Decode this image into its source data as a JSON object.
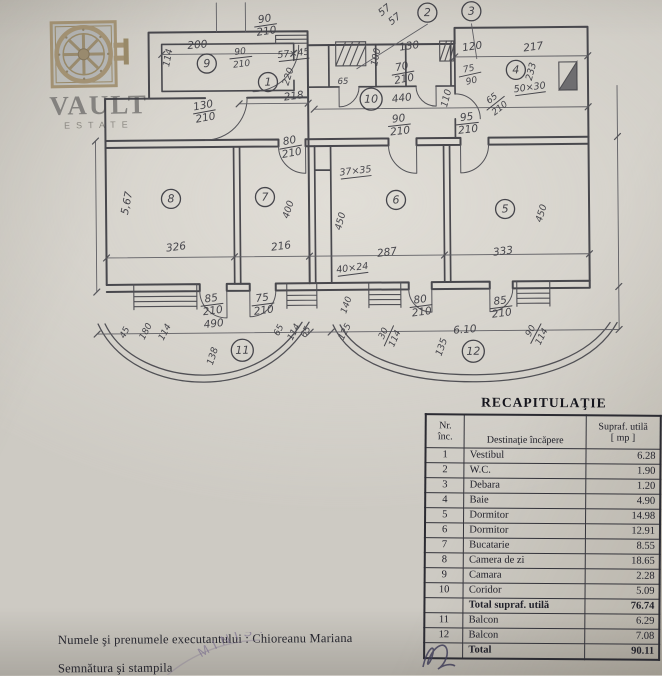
{
  "watermark": {
    "brand": "VAULT",
    "sub": "ESTATE"
  },
  "colors": {
    "paper": "#cdcac3",
    "ink": "#3e3e44",
    "dim_ink": "#56565c",
    "table_ink": "#22222b",
    "stamp": "#766998",
    "logo_bronze": "#97835f"
  },
  "floor_plan": {
    "labels": [
      {
        "t": "200",
        "x": 199,
        "y": 47,
        "r": -4
      },
      {
        "t": "114",
        "x": 172,
        "y": 57,
        "r": -78,
        "s": 9.5
      },
      {
        "t": "9",
        "x": 208,
        "y": 66,
        "c": 1
      },
      {
        "top": "90",
        "bot": "210",
        "x": 242,
        "y": 56,
        "r": -6,
        "s": 9
      },
      {
        "top": "90",
        "bot": "210",
        "x": 267,
        "y": 24,
        "r": -8
      },
      {
        "t": "57×45",
        "x": 295,
        "y": 56,
        "r": -6,
        "u": 1,
        "s": 9.5
      },
      {
        "t": "1",
        "x": 269,
        "y": 85,
        "c": 1
      },
      {
        "t": "220",
        "x": 292,
        "y": 77,
        "r": -72,
        "s": 9.5
      },
      {
        "t": "218",
        "x": 295,
        "y": 99,
        "r": -7
      },
      {
        "top": "130",
        "bot": "210",
        "x": 205,
        "y": 110,
        "r": -10
      },
      {
        "t": "57",
        "x": 388,
        "y": 13,
        "r": -38,
        "s": 10
      },
      {
        "t": "57",
        "x": 398,
        "y": 22,
        "r": -38,
        "s": 10
      },
      {
        "t": "2",
        "x": 429,
        "y": 17,
        "c": 1
      },
      {
        "t": "3",
        "x": 473,
        "y": 16,
        "c": 1
      },
      {
        "t": "130",
        "x": 411,
        "y": 50,
        "r": -8
      },
      {
        "t": "100",
        "x": 380,
        "y": 58,
        "r": -78,
        "s": 9.5
      },
      {
        "top": "70",
        "bot": "210",
        "x": 404,
        "y": 73,
        "r": -10
      },
      {
        "t": "65",
        "x": 344,
        "y": 84,
        "r": 0,
        "s": 8.5
      },
      {
        "t": "10",
        "x": 372,
        "y": 103,
        "c": 1
      },
      {
        "t": "440",
        "x": 403,
        "y": 102,
        "r": -7
      },
      {
        "t": "120",
        "x": 474,
        "y": 51,
        "r": -8
      },
      {
        "top": "75",
        "bot": "90",
        "x": 471,
        "y": 75,
        "r": -12,
        "s": 9
      },
      {
        "t": "110",
        "x": 450,
        "y": 100,
        "r": -75,
        "s": 9.5
      },
      {
        "top": "90",
        "bot": "210",
        "x": 400,
        "y": 125,
        "r": -6
      },
      {
        "top": "95",
        "bot": "210",
        "x": 468,
        "y": 124,
        "r": -6
      },
      {
        "t": "217",
        "x": 535,
        "y": 52,
        "r": -7
      },
      {
        "t": "4",
        "x": 517,
        "y": 75,
        "c": 1
      },
      {
        "t": "233",
        "x": 535,
        "y": 74,
        "r": -75,
        "s": 9.5
      },
      {
        "t": "50×30",
        "x": 531,
        "y": 92,
        "r": -7,
        "u": 1,
        "s": 9.5
      },
      {
        "top": "65",
        "bot": "210",
        "x": 496,
        "y": 104,
        "r": -38,
        "s": 9
      },
      {
        "t": "5,67",
        "x": 130,
        "y": 202,
        "r": -78
      },
      {
        "t": "8",
        "x": 171,
        "y": 201,
        "c": 1
      },
      {
        "t": "326",
        "x": 176,
        "y": 249,
        "r": -7
      },
      {
        "t": "7",
        "x": 265,
        "y": 200,
        "c": 1
      },
      {
        "t": "400",
        "x": 291,
        "y": 210,
        "r": -72,
        "s": 9.5
      },
      {
        "t": "216",
        "x": 281,
        "y": 249,
        "r": -7
      },
      {
        "top": "80",
        "bot": "210",
        "x": 291,
        "y": 146,
        "r": -10
      },
      {
        "t": "37×35",
        "x": 356,
        "y": 174,
        "r": -6,
        "u": 1,
        "s": 9.5
      },
      {
        "t": "6",
        "x": 396,
        "y": 204,
        "c": 1
      },
      {
        "t": "450",
        "x": 343,
        "y": 222,
        "r": -75,
        "s": 9.5
      },
      {
        "t": "287",
        "x": 387,
        "y": 256,
        "r": -7
      },
      {
        "t": "5",
        "x": 505,
        "y": 214,
        "c": 1
      },
      {
        "t": "450",
        "x": 544,
        "y": 216,
        "r": -72,
        "s": 9.5
      },
      {
        "t": "333",
        "x": 503,
        "y": 256,
        "r": -7
      },
      {
        "t": "40×24",
        "x": 352,
        "y": 271,
        "r": -7,
        "u": 1,
        "s": 9.5
      },
      {
        "top": "85",
        "bot": "210",
        "x": 211,
        "y": 303,
        "r": -7
      },
      {
        "top": "75",
        "bot": "210",
        "x": 262,
        "y": 303,
        "r": -7
      },
      {
        "t": "45",
        "x": 126,
        "y": 332,
        "r": -62,
        "s": 9
      },
      {
        "t": "180",
        "x": 147,
        "y": 331,
        "r": -62,
        "s": 9
      },
      {
        "t": "114",
        "x": 166,
        "y": 332,
        "r": -62,
        "s": 9
      },
      {
        "t": "490",
        "x": 213,
        "y": 326,
        "r": -6
      },
      {
        "t": "138",
        "x": 214,
        "y": 356,
        "r": -72,
        "s": 9.5
      },
      {
        "t": "11",
        "x": 241,
        "y": 353,
        "c": 1
      },
      {
        "t": "65",
        "x": 280,
        "y": 331,
        "r": -62,
        "s": 9
      },
      {
        "t": "114",
        "x": 295,
        "y": 333,
        "r": -62,
        "s": 9
      },
      {
        "t": "65",
        "x": 307,
        "y": 333,
        "r": -62,
        "s": 9
      },
      {
        "t": "140",
        "x": 348,
        "y": 306,
        "r": -70,
        "s": 9
      },
      {
        "t": "125",
        "x": 346,
        "y": 333,
        "r": -62,
        "s": 9
      },
      {
        "top": "30",
        "bot": "114",
        "x": 387,
        "y": 336,
        "r": -65,
        "s": 9
      },
      {
        "top": "80",
        "bot": "210",
        "x": 420,
        "y": 306,
        "r": -7
      },
      {
        "t": "6.10",
        "x": 464,
        "y": 334,
        "r": -4
      },
      {
        "t": "135",
        "x": 443,
        "y": 349,
        "r": -70,
        "s": 9.5
      },
      {
        "t": "12",
        "x": 472,
        "y": 356,
        "c": 1
      },
      {
        "top": "85",
        "bot": "210",
        "x": 500,
        "y": 308,
        "r": -7
      },
      {
        "top": "90",
        "bot": "114",
        "x": 534,
        "y": 335,
        "r": -62,
        "s": 9
      }
    ]
  },
  "table": {
    "title": "RECAPITULAŢIE",
    "col_headers": {
      "nr1": "Nr.",
      "nr2": "înc.",
      "dest": "Destinaţie încăpere",
      "sup1": "Supraf. utilă",
      "sup2": "[ mp ]"
    },
    "rows": [
      {
        "nr": "1",
        "dest": "Vestibul",
        "val": "6.28",
        "bold": false
      },
      {
        "nr": "2",
        "dest": "W.C.",
        "val": "1.90",
        "bold": false
      },
      {
        "nr": "3",
        "dest": "Debara",
        "val": "1.20",
        "bold": false
      },
      {
        "nr": "4",
        "dest": "Baie",
        "val": "4.90",
        "bold": false
      },
      {
        "nr": "5",
        "dest": "Dormitor",
        "val": "14.98",
        "bold": false
      },
      {
        "nr": "6",
        "dest": "Dormitor",
        "val": "12.91",
        "bold": false
      },
      {
        "nr": "7",
        "dest": "Bucatarie",
        "val": "8.55",
        "bold": false
      },
      {
        "nr": "8",
        "dest": "Camera de zi",
        "val": "18.65",
        "bold": false
      },
      {
        "nr": "9",
        "dest": "Camara",
        "val": "2.28",
        "bold": false
      },
      {
        "nr": "10",
        "dest": "Coridor",
        "val": "5.09",
        "bold": false
      },
      {
        "nr": "",
        "dest": "Total supraf. utilă",
        "val": "76.74",
        "bold": true
      },
      {
        "nr": "11",
        "dest": "Balcon",
        "val": "6.29",
        "bold": false
      },
      {
        "nr": "12",
        "dest": "Balcon",
        "val": "7.08",
        "bold": false
      },
      {
        "nr": "",
        "dest": "Total",
        "val": "90.11",
        "bold": true
      }
    ]
  },
  "footer": {
    "executor_line": "Numele şi prenumele executantului : Chioreanu Mariana",
    "signature_line": "Semnătura şi stampila",
    "stamp_text": "MINISTRA"
  }
}
